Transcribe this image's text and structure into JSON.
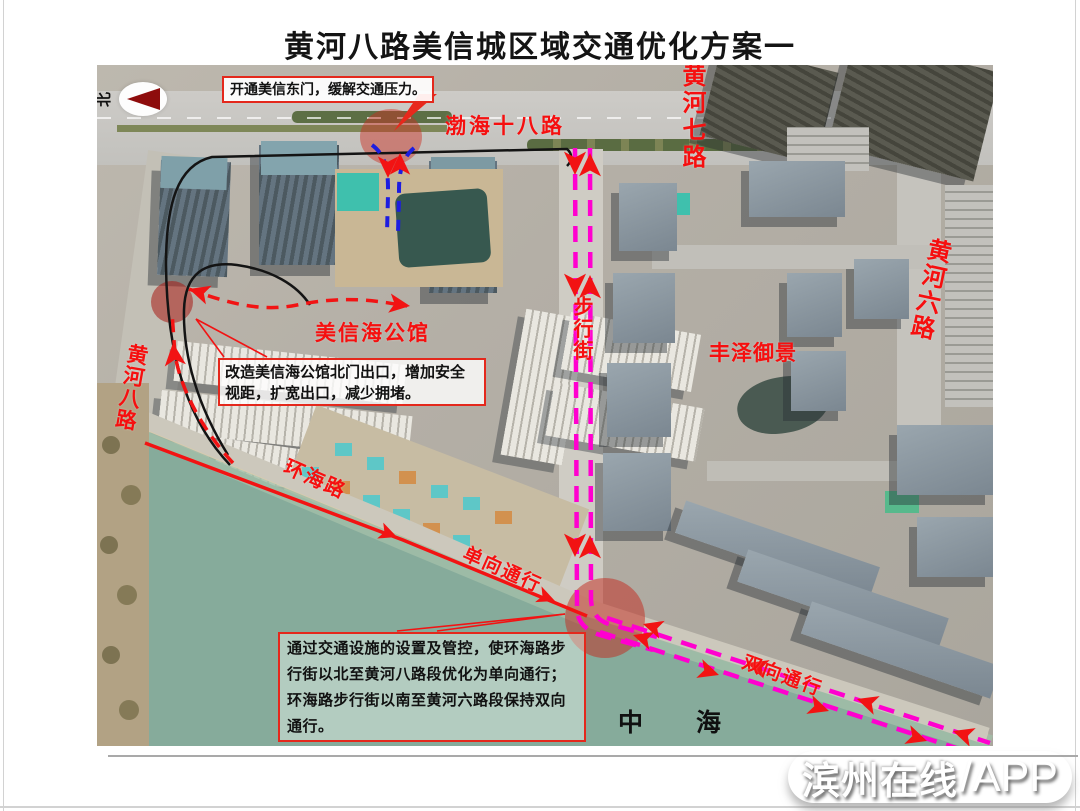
{
  "title": "黄河八路美信城区域交通优化方案一",
  "compass": {
    "north_label": "北"
  },
  "map": {
    "road_labels": {
      "bohai18": "渤海十八路",
      "huanghe7": "黄河七路",
      "huanghe6": "黄河六路",
      "huanghe8": "黄河八路",
      "pedestrian_street": "步行街",
      "huanhai_road": "环海路"
    },
    "place_labels": {
      "meixinhai_mansion": "美信海公馆",
      "fengze_yujing": "丰泽御景",
      "sea": "中　海"
    },
    "flow_labels": {
      "one_way": "单向通行",
      "two_way": "双向通行"
    },
    "notes": {
      "east_gate": "开通美信东门，缓解交通压力。",
      "north_exit": "改造美信海公馆北门出口，增加安全视距，扩宽出口，减少拥堵。",
      "huanhai_control": "通过交通设施的设置及管控，使环海路步行街以北至黄河八路段优化为单向通行；环海路步行街以南至黄河六路段保持双向通行。"
    }
  },
  "watermark": {
    "brand": "滨州在线",
    "suffix": "/APP"
  },
  "colors": {
    "annotation_red": "#f21313",
    "route_magenta": "#ff00cf",
    "gate_blue": "#1d1de0",
    "sea_green": "#86ab9b",
    "label_red": "#f60f0f"
  }
}
